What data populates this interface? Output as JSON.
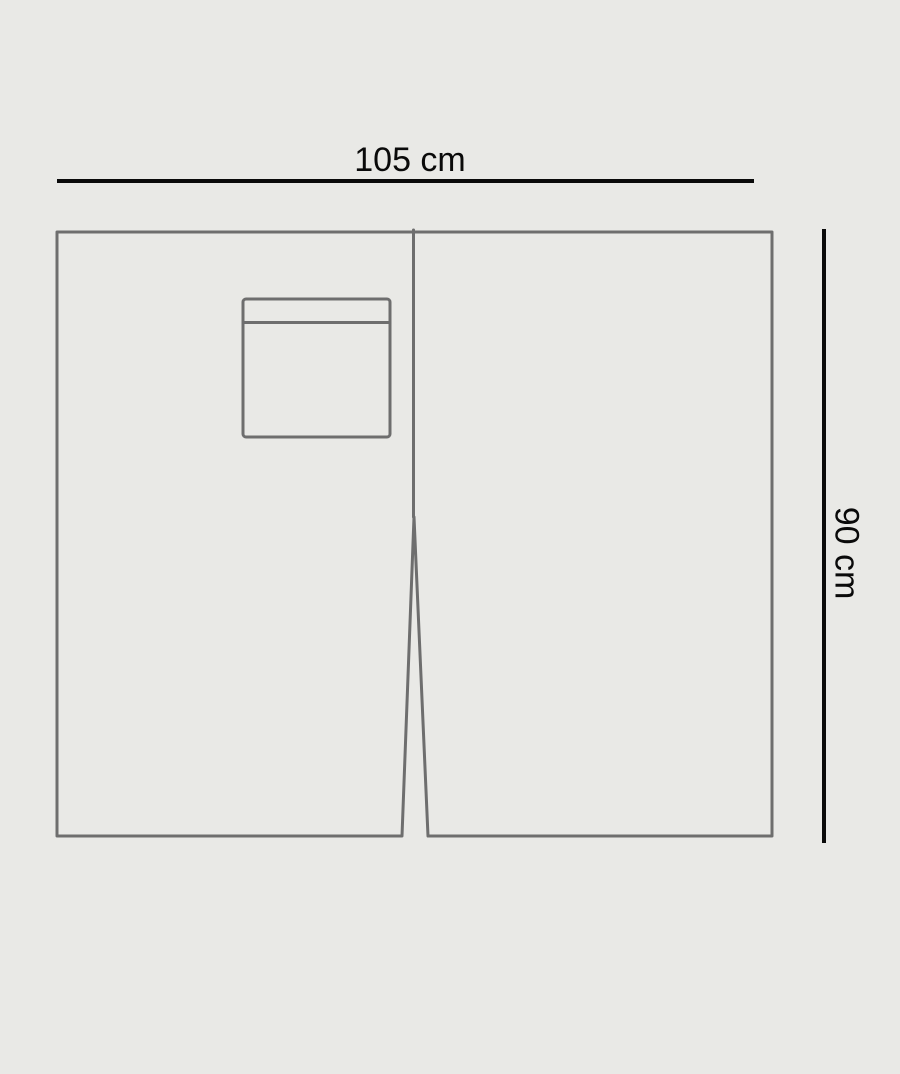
{
  "diagram": {
    "width_label": "105 cm",
    "height_label": "90 cm"
  },
  "colors": {
    "background": "#e9e9e6",
    "outline": "#6e6e6e",
    "dimension": "#0a0a0a"
  },
  "icons": {
    "panel_outline": "panel-with-center-slit-shape",
    "pocket": "patch-pocket-shape"
  }
}
